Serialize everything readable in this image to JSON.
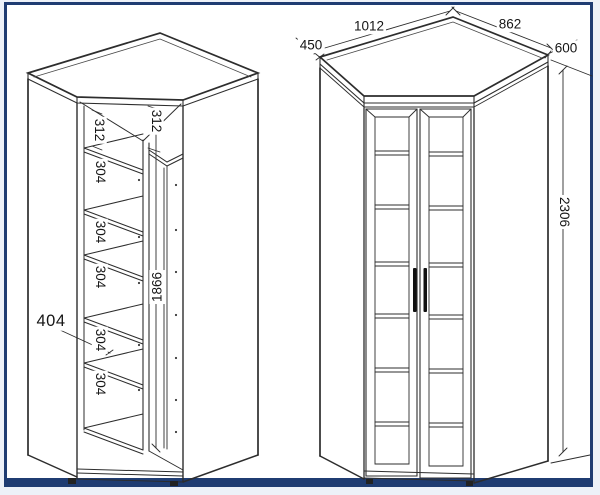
{
  "drawing": {
    "kind": "corner wardrobe dimension drawing",
    "colors": {
      "frame": "#1f3c72",
      "paper": "#ffffff",
      "line": "#2d2d2d",
      "background": "#edf1f8"
    }
  },
  "left_view": {
    "labels": {
      "top_section_left": "312",
      "top_section_right": "312",
      "shelf_gap_1": "304",
      "shelf_gap_2": "304",
      "shelf_gap_3": "304",
      "shelf_gap_4": "304",
      "shelf_gap_5": "304",
      "shelf_depth": "404",
      "interior_height": "1866"
    }
  },
  "right_view": {
    "labels": {
      "back_width_left": "1012",
      "back_width_right": "862",
      "side_depth_left": "450",
      "side_depth_right": "600",
      "overall_height": "2306"
    }
  }
}
